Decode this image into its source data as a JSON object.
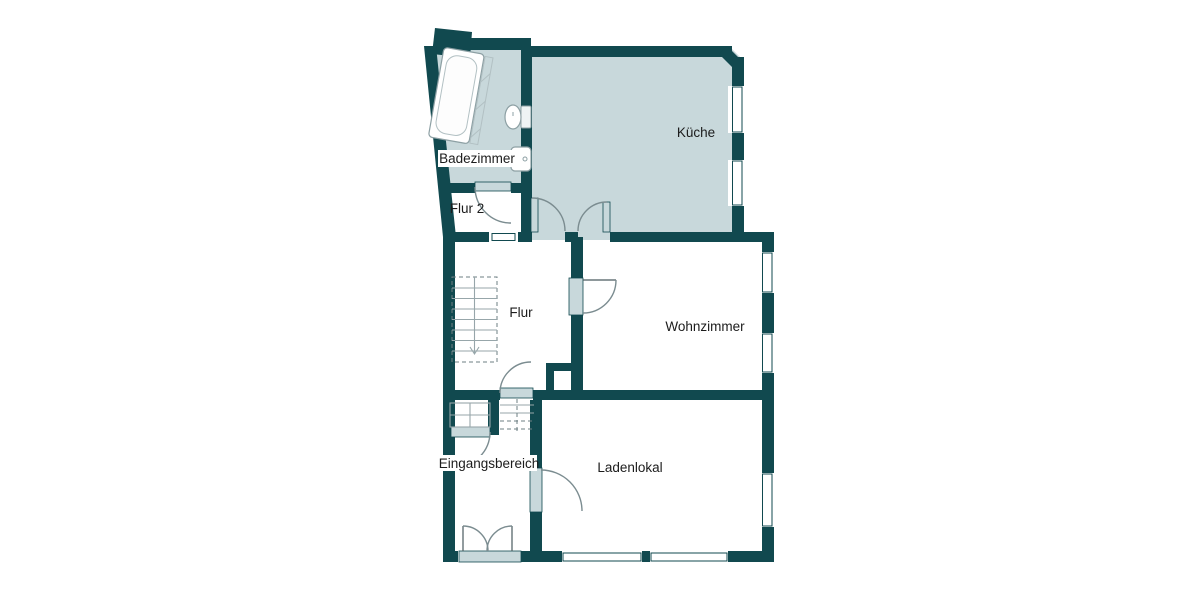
{
  "plan": {
    "type": "floor-plan",
    "rooms": {
      "badezimmer": {
        "label": "Badezimmer"
      },
      "flur2": {
        "label": "Flur 2"
      },
      "kueche": {
        "label": "Küche"
      },
      "flur": {
        "label": "Flur"
      },
      "wohnzimmer": {
        "label": "Wohnzimmer"
      },
      "eingangsbereich": {
        "label": "Eingangsbereich"
      },
      "ladenlokal": {
        "label": "Ladenlokal"
      }
    },
    "fixtures": {
      "bathtub": "bathtub-icon",
      "toilet": "toilet-icon",
      "sink": "sink-icon",
      "stairs_flur": "stairs-down-icon",
      "stairs_entrance": "stairs-icon",
      "entrance_double_door": "double-door-icon"
    },
    "colors": {
      "wall": "#11494f",
      "wet_room_fill": "#c8d8db",
      "door_arc": "#7b8c90",
      "text": "#1c1c1c",
      "background": "#ffffff"
    }
  }
}
